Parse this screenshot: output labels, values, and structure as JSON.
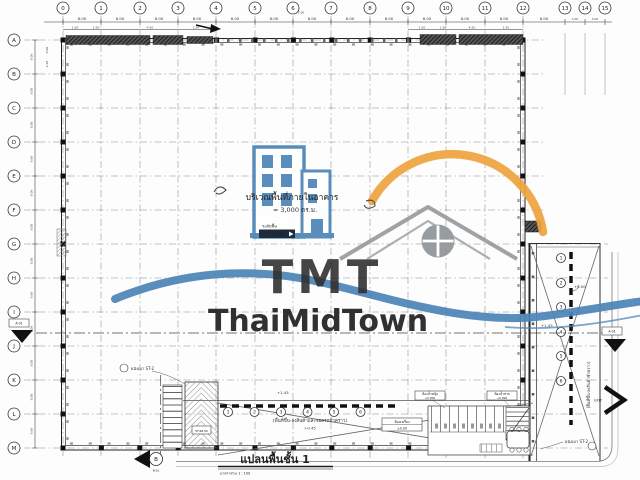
{
  "drawing": {
    "title": "แปลนพื้นชั้น 1",
    "scale_note": "มาตราส่วน 1 : 100"
  },
  "grid": {
    "columns": [
      "0",
      "1",
      "2",
      "3",
      "4",
      "5",
      "6",
      "7",
      "8",
      "9",
      "10",
      "11",
      "12",
      "13",
      "14",
      "15"
    ],
    "rows": [
      "A",
      "B",
      "C",
      "D",
      "E",
      "F",
      "G",
      "H",
      "I",
      "J",
      "K",
      "L",
      "M"
    ],
    "bay_dim": "6.00",
    "overall_dim": "72.00",
    "sub_dim_a": "1.50",
    "sub_dim_b": "4.50",
    "sub_dim_c": "0.60",
    "sub_dim_d": "2.40",
    "right_dim": "3.00"
  },
  "annotations": {
    "interior_area_label": "บริเวณพื้นที่ภายในอาคาร",
    "interior_area_value": "≈ 3,000 ตร.ม.",
    "floor_level_caption": "ระดับพื้น",
    "floor_level_tag": "FL. ±0.00",
    "canopy_upper_level": "+1.45",
    "canopy_area_label": "(พื้นที่ขึ้น-ลงสินค้าและจอดรถชั่วคราว)",
    "canopy_area_level": "+0.45",
    "dock_zero_level": "+0.00",
    "dock_upper_level": "+1.45",
    "dock_side_label": "(พื้นที่ขึ้น-ลงสินค้าชั่วคราว)",
    "light_wall_left": "ผนังเบา ST-2",
    "light_wall_right": "ผนังเบา ST-2",
    "ramp_label": "ทางลาด",
    "exit_label": "EXIT",
    "toilet_tag_female": "ห้องน้ำหญิง",
    "toilet_tag_female_level": "+0.000",
    "toilet_tag_male": "ห้องน้ำชาย",
    "toilet_tag_male_level": "+0.000",
    "room_tag": "ห้องเครื่อง",
    "room_tag_level": "±0.00"
  },
  "markers": {
    "section_a": "A",
    "section_a_ref": "A-01",
    "section_b": "B",
    "section_b_ref": "B-01",
    "dock_bay_numbers": [
      "1",
      "2",
      "3",
      "4",
      "5",
      "6"
    ],
    "canopy_bay_numbers": [
      "1",
      "2",
      "3",
      "4",
      "5",
      "6"
    ]
  },
  "watermark": {
    "initials": "TMT",
    "brand": "ThaiMidTown",
    "colors": {
      "blue": "#4d86b8",
      "gray": "#95979a",
      "orange": "#f0a441"
    }
  }
}
